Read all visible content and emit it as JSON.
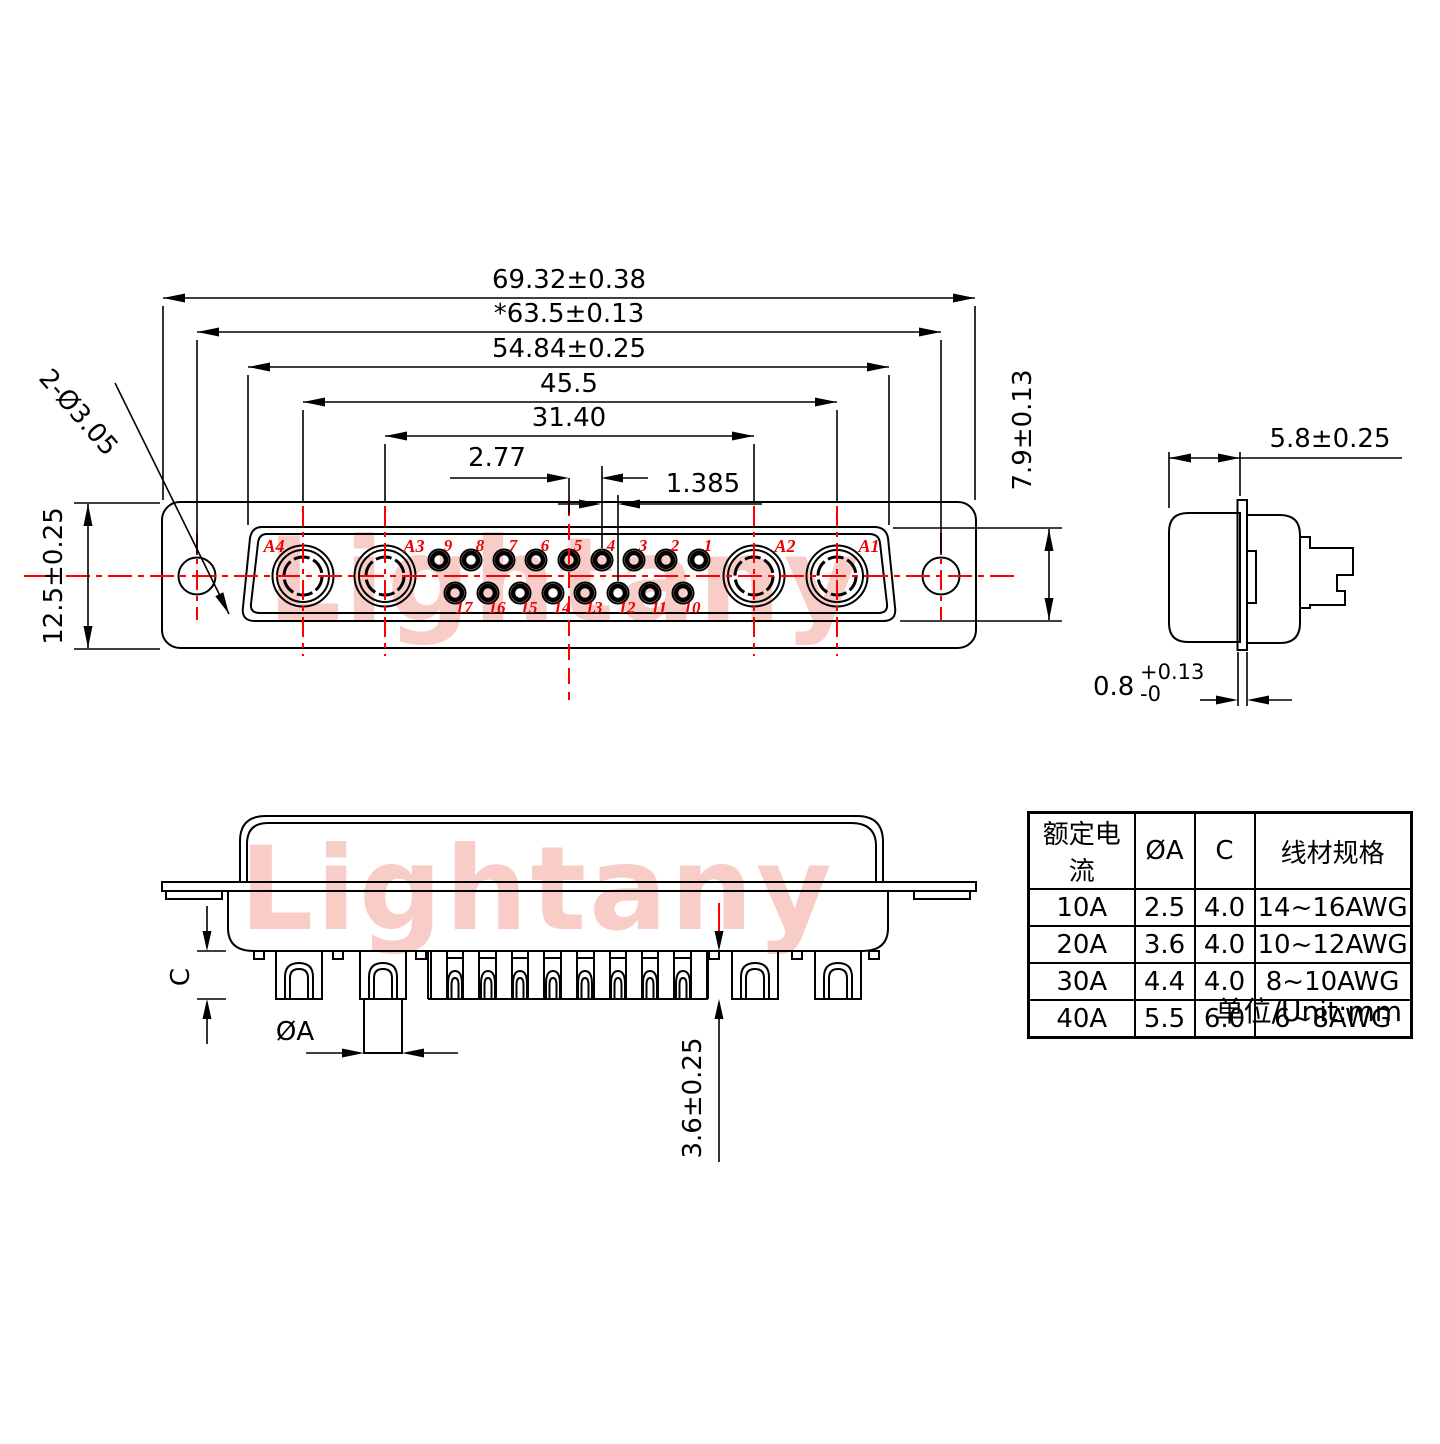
{
  "watermark": {
    "text": "Lightany"
  },
  "front_view": {
    "dimensions": {
      "width_outer": "69.32±0.38",
      "width_holes": "*63.5±0.13",
      "width_shell": "54.84±0.25",
      "width_a_outer": "45.5",
      "width_a_inner": "31.40",
      "pin_pitch": "2.77",
      "row_offset": "1.385",
      "flange_height": "12.5±0.25",
      "mount_hole": "2-Ø3.05",
      "shell_height": "7.9±0.13"
    },
    "contact_labels": {
      "a1": "A1",
      "a2": "A2",
      "a3": "A3",
      "a4": "A4"
    },
    "pins_top": [
      "9",
      "8",
      "7",
      "6",
      "5",
      "4",
      "3",
      "2",
      "1"
    ],
    "pins_bottom": [
      "17",
      "16",
      "15",
      "14",
      "13",
      "12",
      "11",
      "10"
    ]
  },
  "side_view": {
    "depth": "5.8±0.25",
    "flange_thickness": "0.8",
    "tol_plus": "+0.13",
    "tol_minus": "-0"
  },
  "section_view": {
    "cup_depth": "C",
    "pin_diameter": "ØA",
    "standoff": "3.6±0.25"
  },
  "table": {
    "headers": [
      "额定电流",
      "ØA",
      "C",
      "线材规格"
    ],
    "rows": [
      [
        "10A",
        "2.5",
        "4.0",
        "14~16AWG"
      ],
      [
        "20A",
        "3.6",
        "4.0",
        "10~12AWG"
      ],
      [
        "30A",
        "4.4",
        "4.0",
        "8~10AWG"
      ],
      [
        "40A",
        "5.5",
        "6.0",
        "6~8AWG"
      ]
    ],
    "unit_note": "单位/Unit:mm"
  },
  "colors": {
    "line": "#000000",
    "centerline": "#ff0000",
    "label_red": "#ee0000",
    "watermark_pink": "#f8ccc7"
  }
}
